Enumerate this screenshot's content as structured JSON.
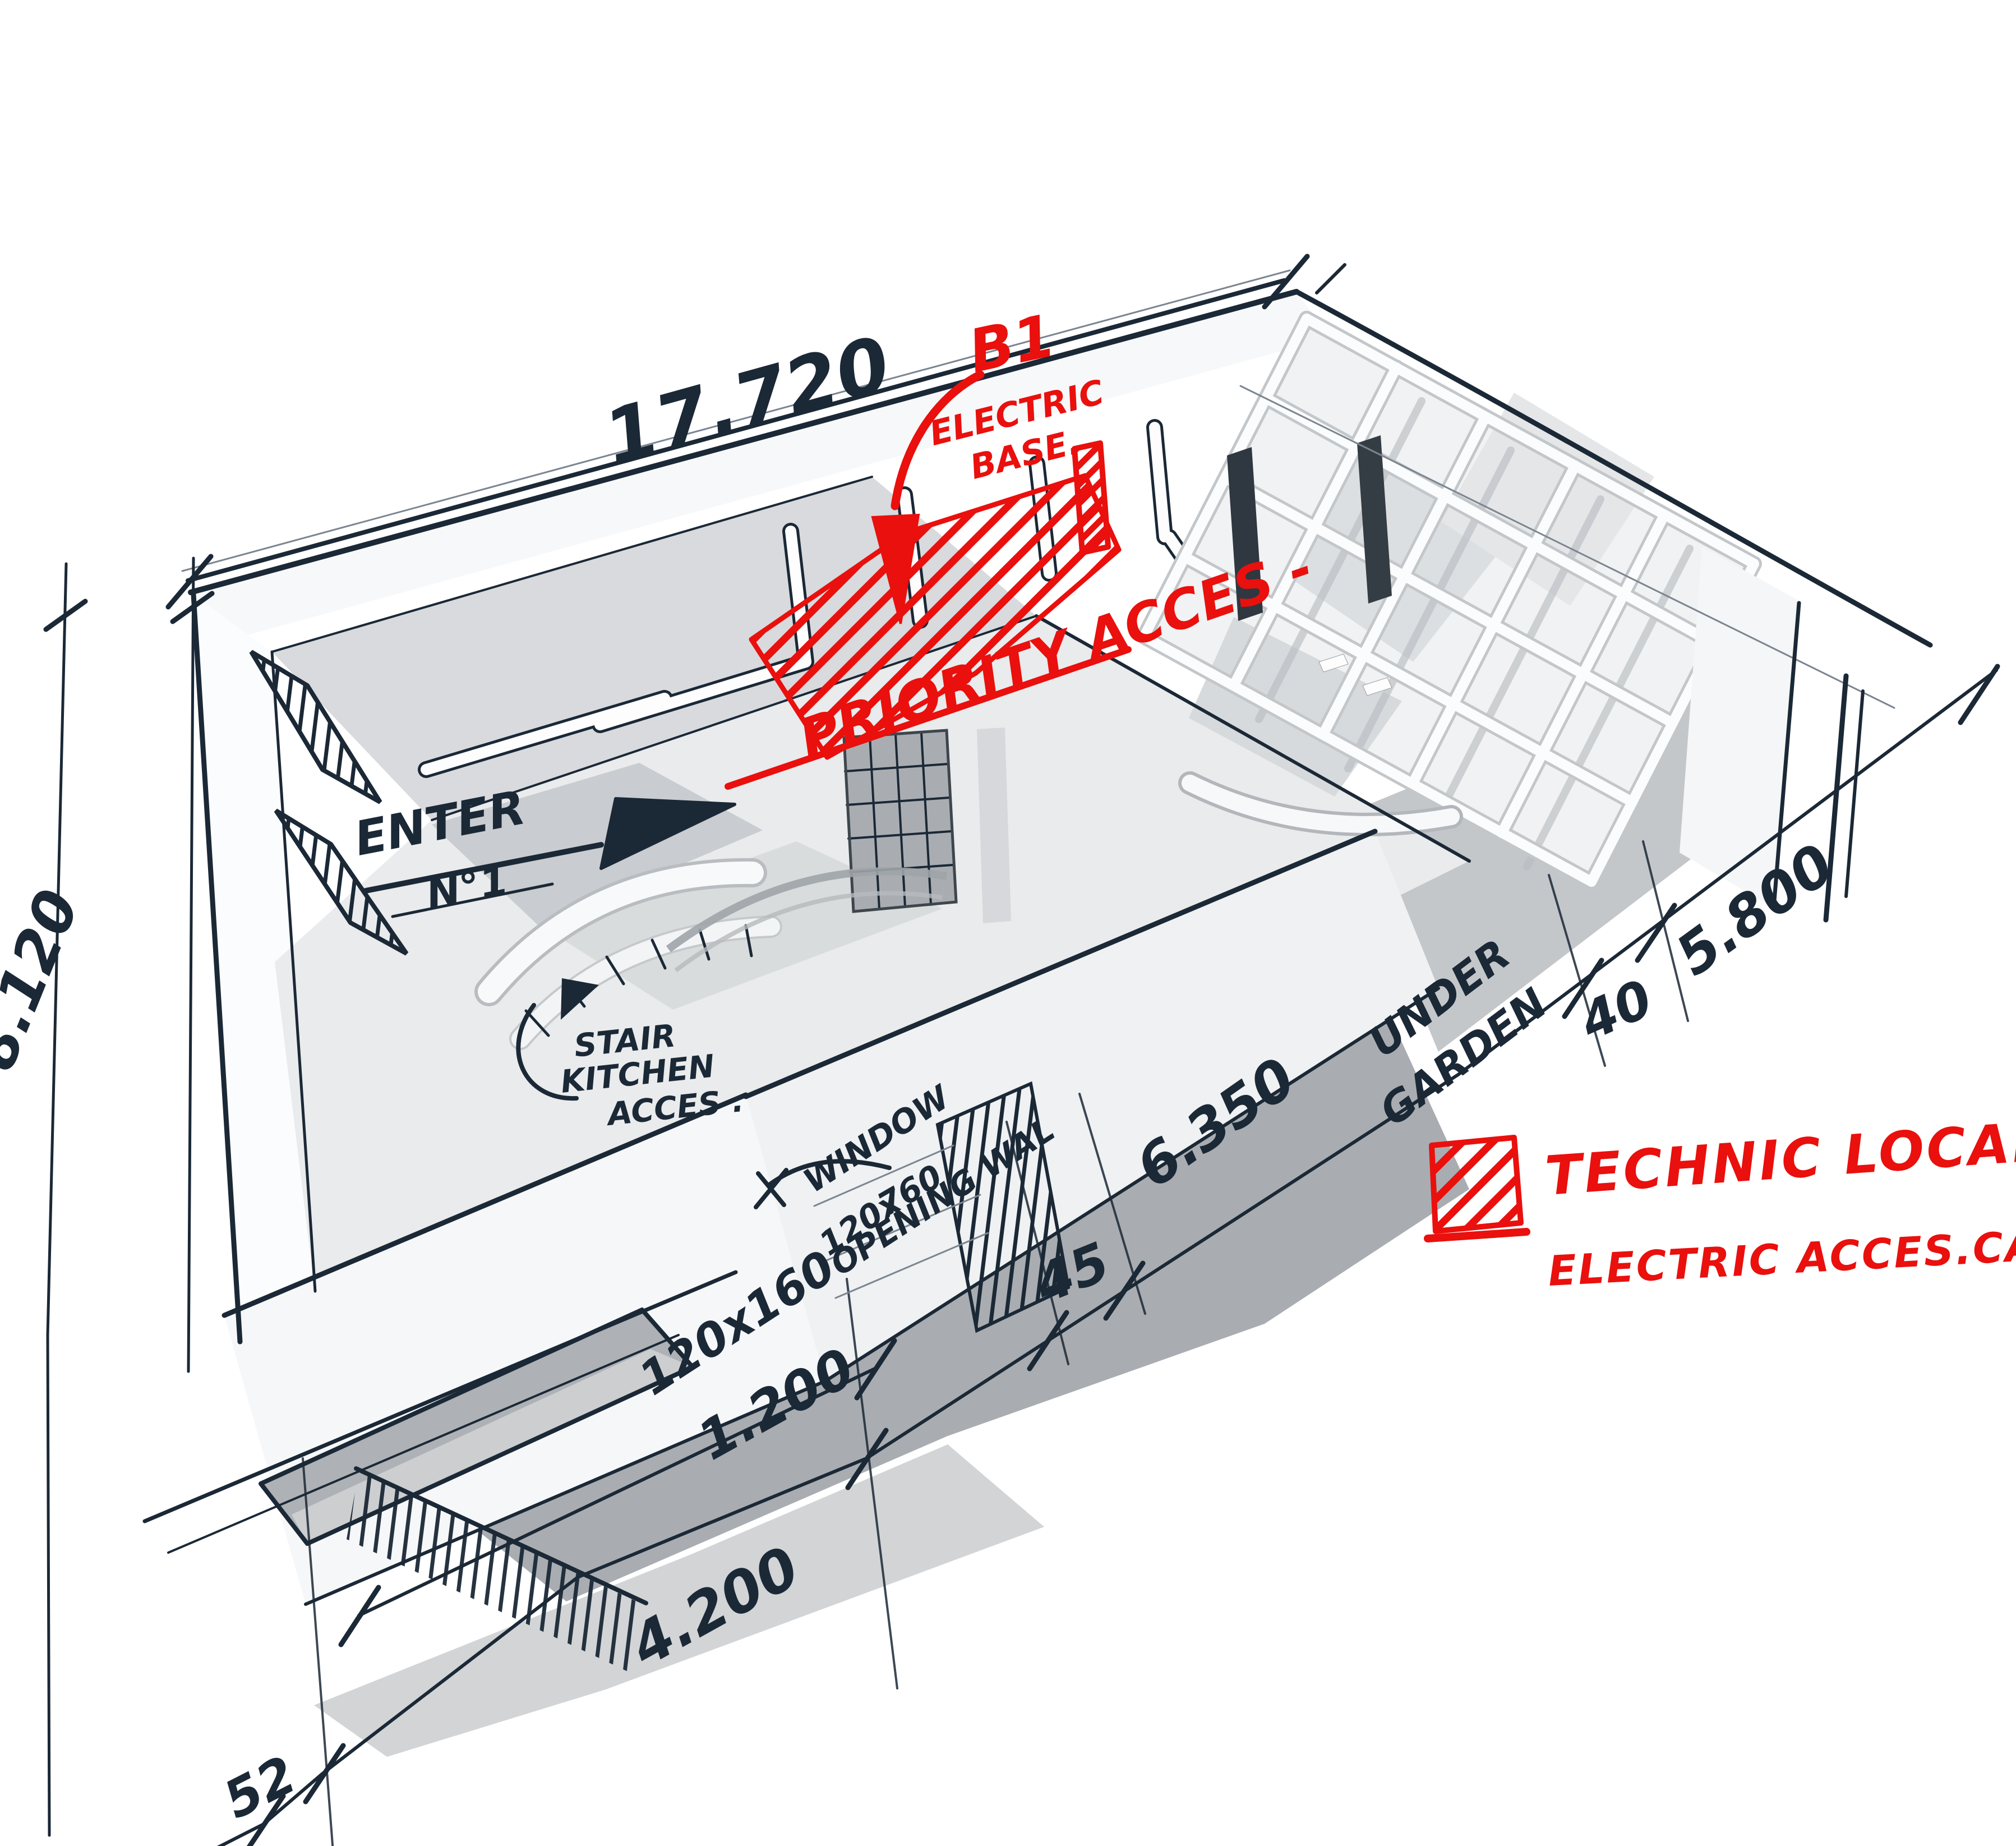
{
  "colors": {
    "paper": "#ffffff",
    "ink": "#1b2836",
    "red": "#e9100d",
    "shadow": "#a9adb1"
  },
  "dimensions": {
    "top": "17.720",
    "left": "8.120",
    "offset": "52",
    "bottom": "4.200",
    "window_line": "1.200",
    "window_size": "120x160",
    "wall": "45",
    "garden": "6.350",
    "gap": "40",
    "right": "5.800"
  },
  "notes": {
    "b1_line1": "B1",
    "b1_line2": "ELECTRIC",
    "b1_line3": "BASE.",
    "priority": "PRIORITY ACCES -",
    "enter_line1": "ENTER",
    "enter_line2": "N°1",
    "stair_line1": "STAIR",
    "stair_line2": "KITCHEN",
    "stair_line3": "ACCES .",
    "window_line1": "WINDOW",
    "window_line2": "120x",
    "window_line3": "760",
    "window_line4": "OPENING WAL",
    "garden_line1": "UNDER",
    "garden_line2": "GARDEN"
  },
  "legend": {
    "title": "TECHNIC LOCAL",
    "subtitle": "ELECTRIC ACCES.CABLE",
    "swatch_icon": "red-hatch-swatch"
  }
}
